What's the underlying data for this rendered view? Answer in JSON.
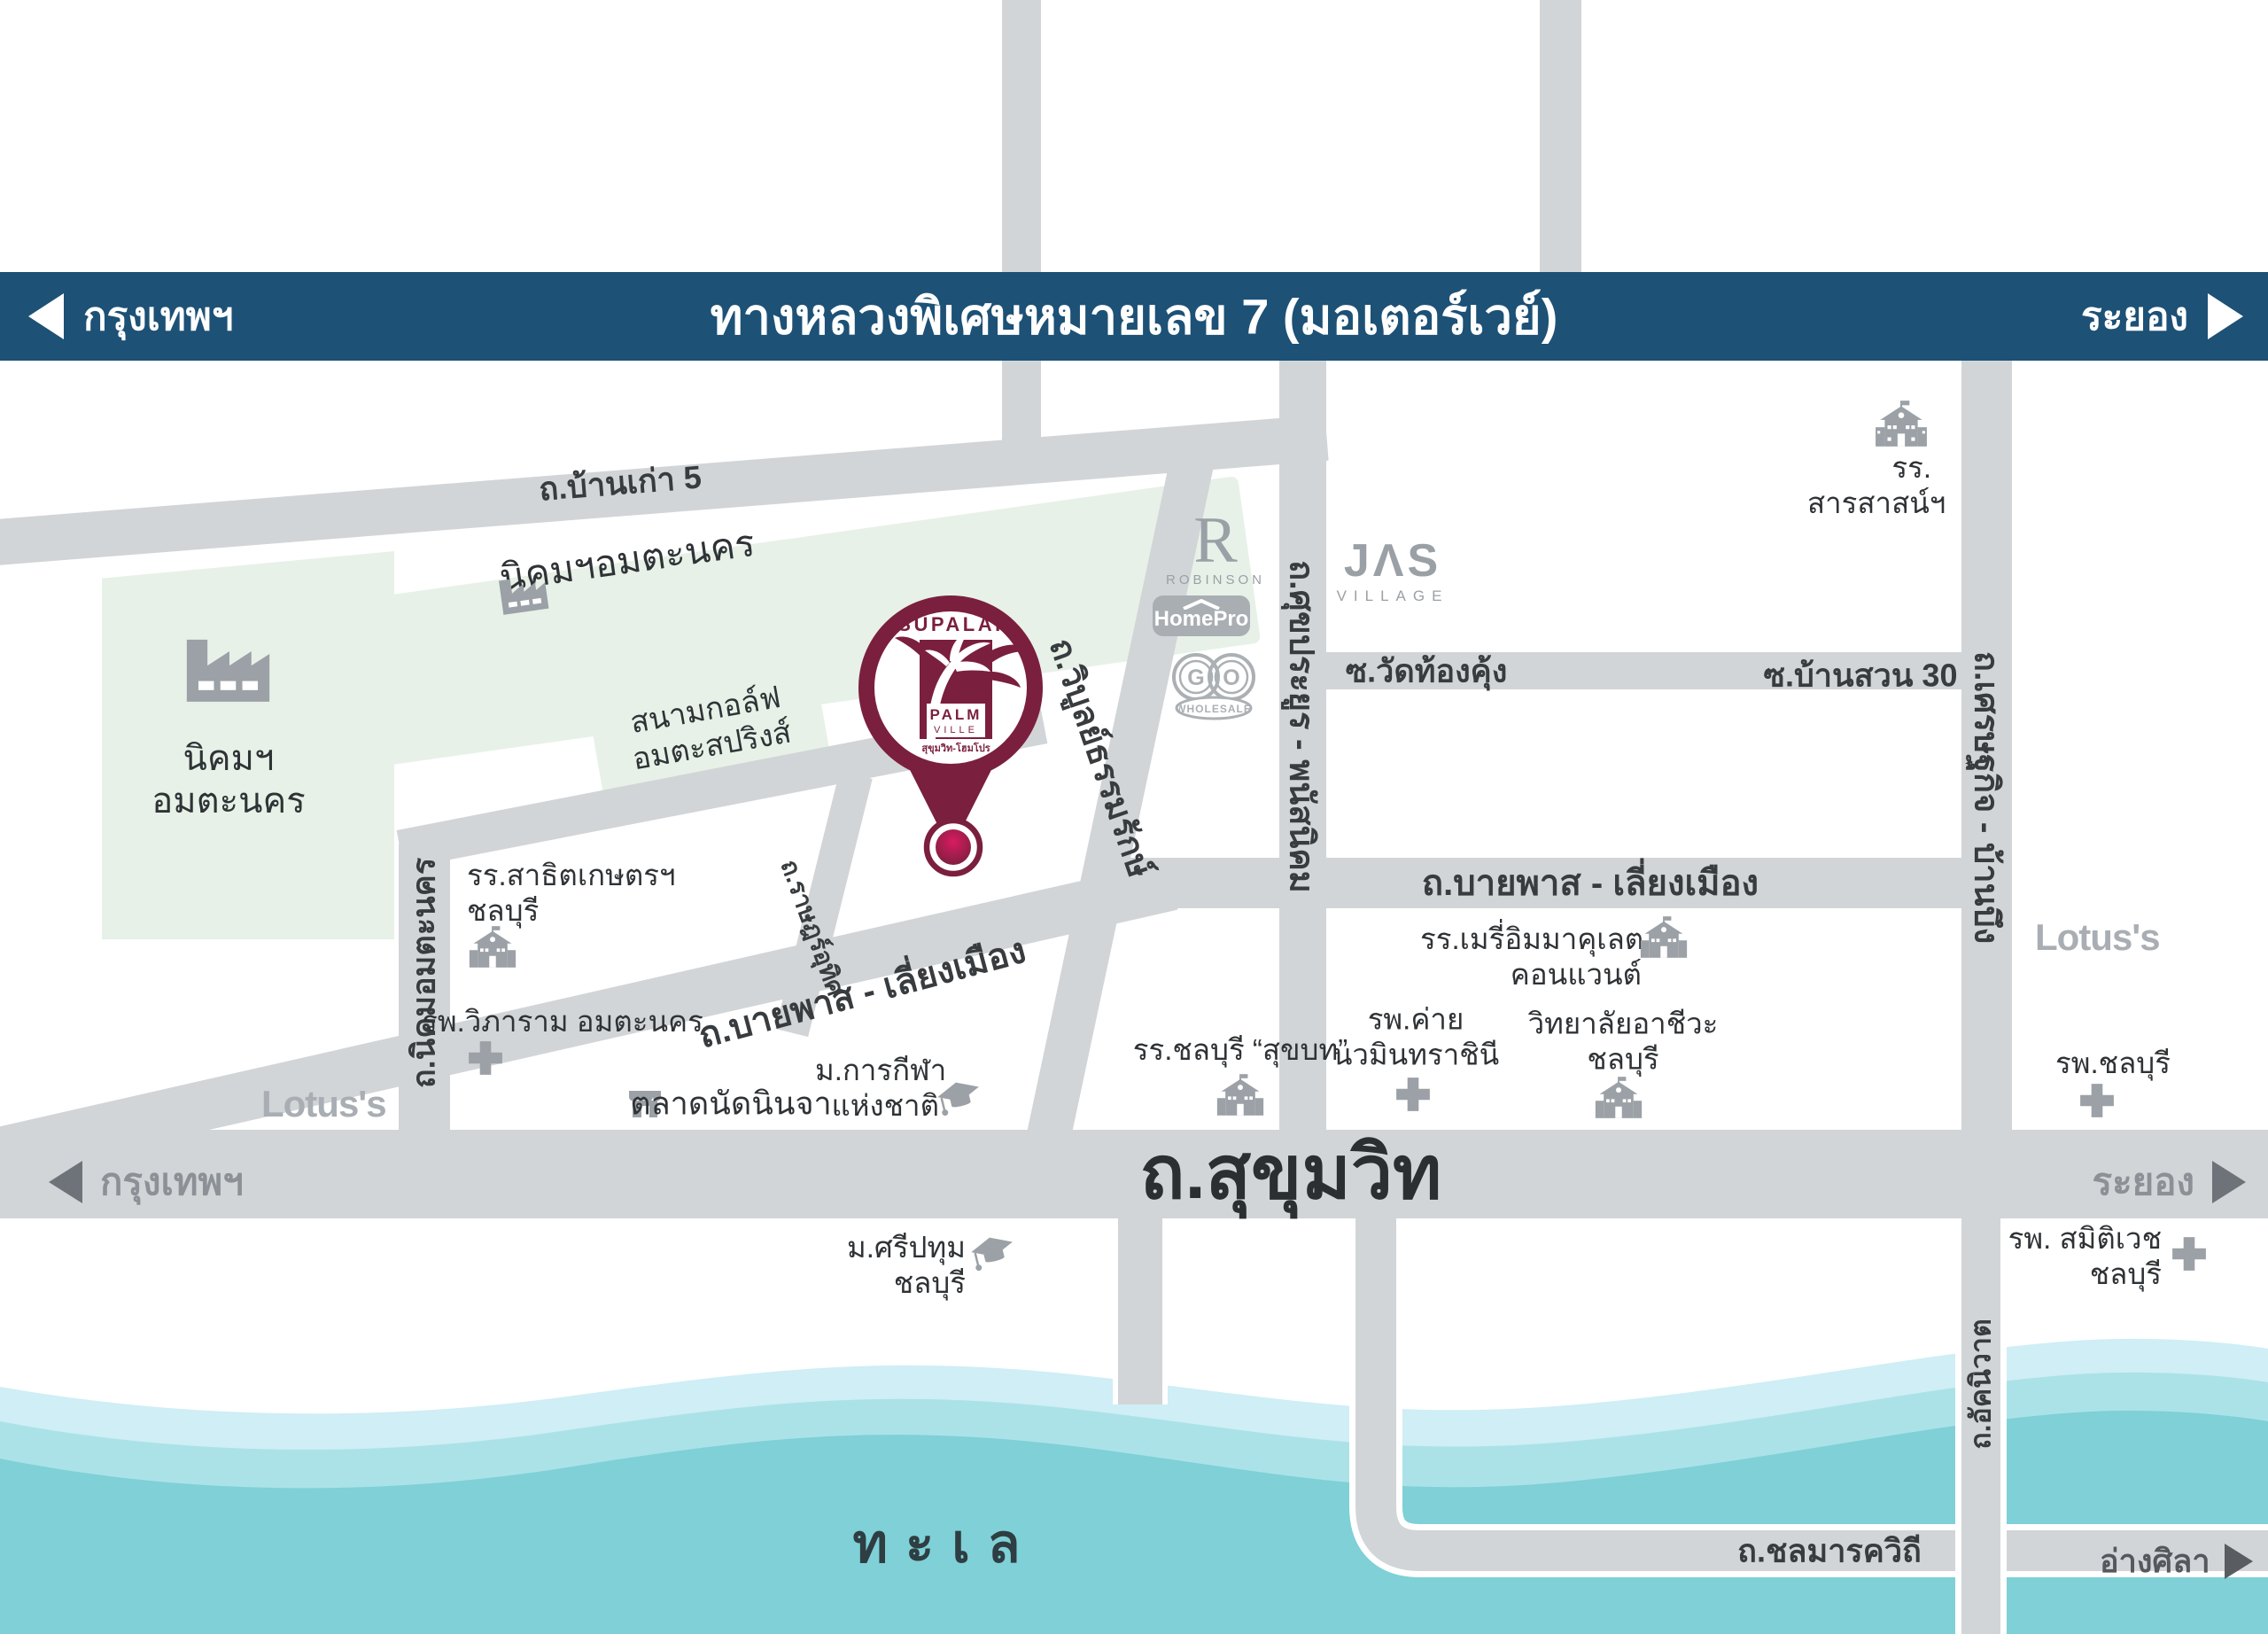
{
  "banner": {
    "left": "กรุงเทพฯ",
    "title": "ทางหลวงพิเศษหมายเลข 7 (มอเตอร์เวย์)",
    "right": "ระยอง"
  },
  "topRoads": {
    "phanatnikhom": "พนัสนิคม",
    "wangchan": "วังจันทร์"
  },
  "roadLabels": {
    "bankao": "ถ.บ้านเก่า 5",
    "sukprayoon": "ถ.ศุขประยูร - พนัสนิคม",
    "wiboon": "ถ.วิบูลย์ธรรมรักษ์",
    "watthongkhung": "ซ.วัดท้องคุ้ง",
    "bansuan": "ซ.บ้านสวน 30",
    "setthakit": "ถ.เศรษฐกิจ - บ้านบึง",
    "bypassDiagonal": "ถ.บายพาส - เลี่ยงเมือง",
    "bypassHorizontal": "ถ.บายพาส - เลี่ยงเมือง",
    "nikhomAmata": "ถ.นิคมอมตะนคร",
    "ratsadon": "ถ.ราษฎร์อุทิศ",
    "sukhumvit": "ถ.สุขุมวิท",
    "sukhumvitLeft": "กรุงเทพฯ",
    "sukhumvitRight": "ระยอง",
    "chonmarak": "ถ.ชลมารควิถี",
    "angsila": "อ่างศิลา",
    "akkaniwat": "ถ.อัคนิวาต"
  },
  "areas": {
    "amataLeft1": "นิคมฯ",
    "amataLeft2": "อมตะนคร",
    "amataStrip": "นิคมฯอมตะนคร",
    "golf1": "สนามกอล์ฟ",
    "golf2": "อมตะสปริงส์",
    "sea": "ทะเล"
  },
  "landmarks": {
    "sarasas1": "รร.",
    "sarasas2": "สารสาสน์ฯ",
    "satit1": "รร.สาธิตเกษตรฯ",
    "satit2": "ชลบุรี",
    "vibharam": "รพ.วิภาราม อมตะนคร",
    "lotusLeft": "Lotus's",
    "ninjaMarket": "ตลาดนัดนินจา",
    "sportU1": "ม.การกีฬา",
    "sportU2": "แห่งชาติ",
    "sripatum1": "ม.ศรีปทุม",
    "sripatum2": "ชลบุรี",
    "sukkhabot": "รร.ชลบุรี “สุขบท”",
    "navamin1": "รพ.ค่าย",
    "navamin2": "นวมินทราชินี",
    "merry1": "รร.เมรี่อิมมาคุเลต",
    "merry2": "คอนแวนต์",
    "vocational1": "วิทยาลัยอาชีวะ",
    "vocational2": "ชลบุรี",
    "lotusRight": "Lotus's",
    "chonburiHospital": "รพ.ชลบุรี",
    "samitivej1": "รพ. สมิติเวช",
    "samitivej2": "ชลบุรี"
  },
  "logos": {
    "robinsonR": "R",
    "robinson": "ROBINSON",
    "homepro": "HomePro",
    "goG": "G",
    "goO": "O",
    "goSub": "WHOLESALE",
    "jas": "JΛS",
    "jasSub": "VILLAGE"
  },
  "pin": {
    "brand": "SUPALAI",
    "palm": "PALM",
    "ville": "VILLE",
    "subtitle": "สุขุมวิท-โฮมโปร"
  },
  "colors": {
    "banner": "#1d5176",
    "road": "#d2d5d7",
    "green": "#e7f1e8",
    "seaLight": "#cfeef5",
    "seaMid": "#abe2e8",
    "seaDeep": "#7fd0d7",
    "brand": "#7b1f3e",
    "icon": "#9ba1a6",
    "labelDark": "#383c3f"
  }
}
